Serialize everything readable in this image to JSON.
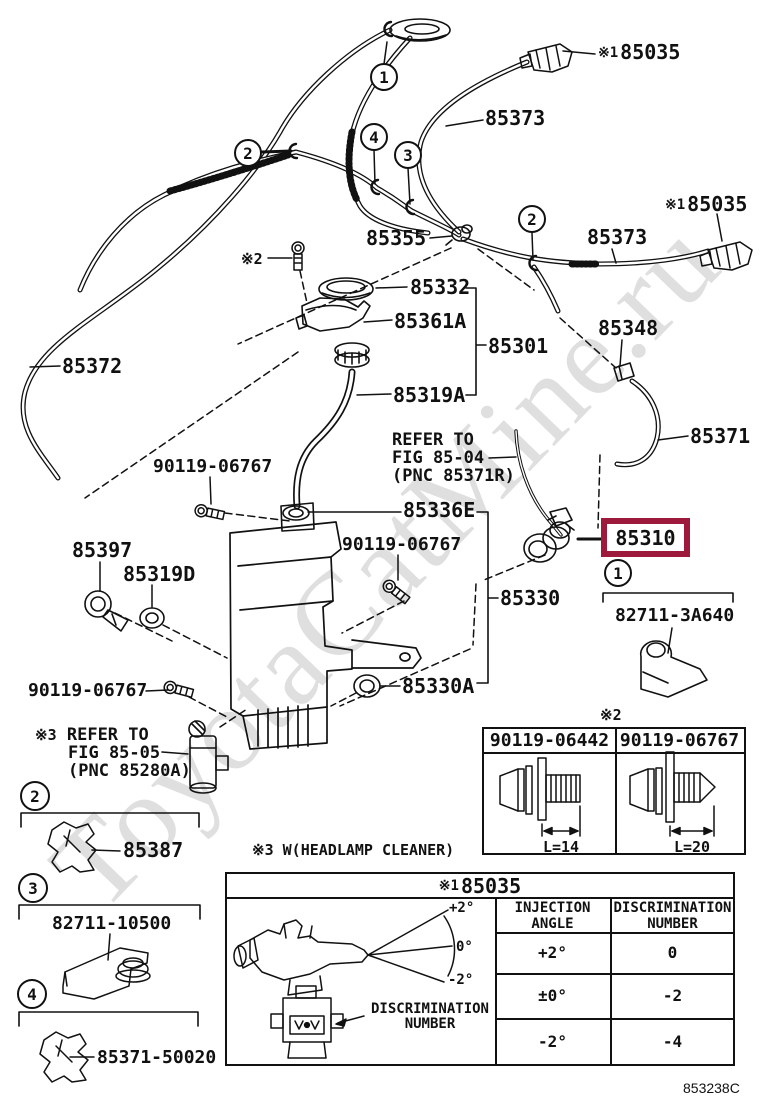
{
  "watermark": "ToyotaCatMine.ru",
  "doc_code": "853238C",
  "colors": {
    "highlight": "#9e1a3d",
    "line": "#111111",
    "watermark": "#cccccc"
  },
  "labels": {
    "p85035_top": "85035",
    "p85035_mid": "85035",
    "p85373_top": "85373",
    "p85373_mid": "85373",
    "p85355": "85355",
    "p85332": "85332",
    "p85361a": "85361A",
    "p85301": "85301",
    "p85348": "85348",
    "p85319a": "85319A",
    "p85372": "85372",
    "p85371": "85371",
    "p90119_06767_top": "90119-06767",
    "p90119_06767_right": "90119-06767",
    "p90119_06767_left": "90119-06767",
    "p85336e": "85336E",
    "p85397": "85397",
    "p85319d": "85319D",
    "p85310": "85310",
    "p85330": "85330",
    "p85330a": "85330A",
    "p82711_3a640": "82711-3A640",
    "p85387": "85387",
    "p82711_10500": "82711-10500",
    "p85371_50020": "85371-50020"
  },
  "notes": {
    "star1": "※1",
    "star2": "※2",
    "star3": "※3",
    "refer1_l1": "REFER TO",
    "refer1_l2": "FIG 85-04",
    "refer1_l3": "(PNC 85371R)",
    "refer2_l1": "REFER TO",
    "refer2_l2": "FIG 85-05",
    "refer2_l3": "(PNC 85280A)",
    "headlamp": "※3 W(HEADLAMP CLEANER)"
  },
  "callouts": {
    "c1": "1",
    "c2": "2",
    "c3": "3",
    "c4": "4"
  },
  "bolt_table": {
    "note": "※2",
    "col1_part": "90119-06442",
    "col1_dim": "L=14",
    "col2_part": "90119-06767",
    "col2_dim": "L=20"
  },
  "nozzle_table": {
    "title_prefix": "※1",
    "title": "85035",
    "hdr_angle_1": "INJECTION",
    "hdr_angle_2": "ANGLE",
    "hdr_disc_1": "DISCRIMINATION",
    "hdr_disc_2": "NUMBER",
    "rows": [
      {
        "angle": "+2°",
        "num": "0"
      },
      {
        "angle": "±0°",
        "num": "-2"
      },
      {
        "angle": "-2°",
        "num": "-4"
      }
    ],
    "fan_top": "+2°",
    "fan_mid": "0°",
    "fan_bot": "-2°",
    "disc_1": "DISCRIMINATION",
    "disc_2": "NUMBER"
  }
}
